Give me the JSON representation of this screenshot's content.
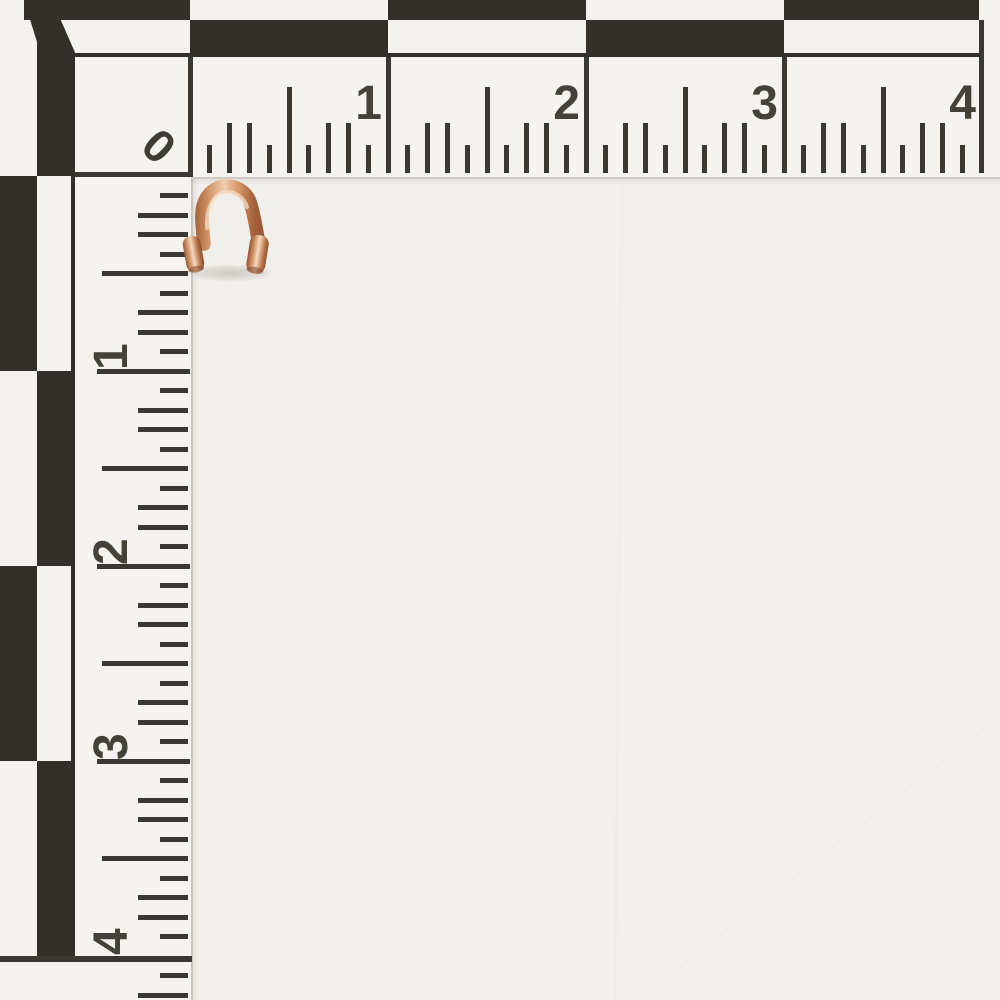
{
  "scene": {
    "subject": "Copper wire guardian (U-shaped wire protector) photographed on a white background",
    "scale_card": "L-shaped photo measurement scale in inches with checkerboard border"
  },
  "ruler": {
    "zero_label": "0",
    "top_labels": [
      "1",
      "2",
      "3",
      "4"
    ],
    "left_labels": [
      "1",
      "2",
      "3",
      "4"
    ],
    "tick_pattern": [
      "short",
      "medium",
      "medium",
      "short",
      "tall",
      "short",
      "medium",
      "medium",
      "short"
    ],
    "tick_lengths": {
      "short": 28,
      "medium": 50,
      "tall": 86,
      "inch": 116
    },
    "ink_color": "#3b3833",
    "number_color": "#44413b",
    "checker_black": "#33302c",
    "card_white": "#f4f3ef"
  },
  "geometry": {
    "top_ruler": {
      "origin_x": 190,
      "inch_px": 198,
      "baseline_y": 173,
      "line_top_y": 57,
      "tick_width": 5,
      "minor_step": 19.8
    },
    "left_ruler": {
      "origin_y": 176,
      "inch_px": 195,
      "baseline_x": 188,
      "line_left_x": 97,
      "tick_height": 5,
      "minor_step": 19.5,
      "extra_ticks": [
        {
          "pos": 4.1,
          "len": "short"
        },
        {
          "pos": 4.2,
          "len": "medium"
        }
      ]
    },
    "checkerboard": {
      "outer_band_px": 20,
      "top_inner_band_bottom": 57,
      "left_inner_band_right": 71,
      "top_outer_black": [
        [
          24,
          190
        ],
        [
          388,
          586
        ],
        [
          784,
          979
        ]
      ],
      "top_inner_black": [
        [
          190,
          388
        ],
        [
          586,
          784
        ]
      ],
      "left_outer_black": [
        [
          176,
          371
        ],
        [
          566,
          761
        ]
      ],
      "left_inner_black": [
        [
          45,
          176
        ],
        [
          371,
          566
        ],
        [
          761,
          958
        ]
      ],
      "corner_wedge": "24,0 52,0 77,57 37,57 37,42"
    },
    "rules": {
      "top_rule_y": 53,
      "top_rule_span": [
        73,
        979
      ],
      "left_rule_x": 71,
      "left_rule_span": [
        53,
        958
      ],
      "top_end_line": {
        "x": 979,
        "y1": 20,
        "y2": 173
      },
      "left_end_line": {
        "y": 956,
        "x1": 0,
        "x2": 192
      }
    }
  },
  "object_item": {
    "name": "copper wire guard",
    "copper_light": "#f0cfae",
    "copper_mid": "#cf9165",
    "copper_dark": "#8a4a28",
    "crimp_dark": "#7c3f22"
  },
  "background": {
    "color": "#f0efeb",
    "card_edge": "#c9c6bf"
  }
}
